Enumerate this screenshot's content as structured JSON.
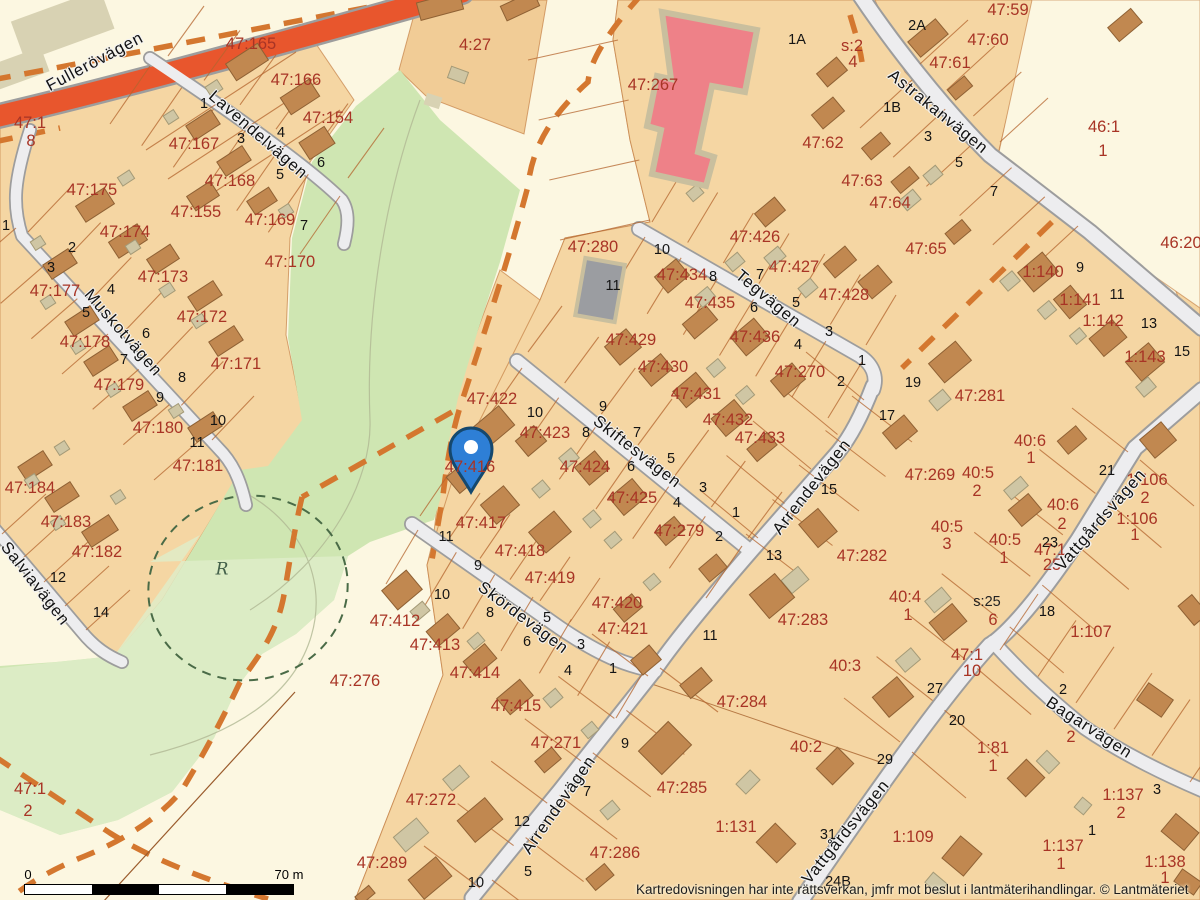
{
  "map": {
    "attribution": "Kartredovisningen har inte rättsverkan, jmfr mot beslut i lantmäterihandlingar. © Lantmäteriet",
    "scale_bar": {
      "start_label": "0",
      "end_label": "70 m"
    },
    "marker": {
      "name": "location-pin",
      "fill": "#2e7fd6",
      "stroke": "#15486e",
      "dot": "#ffffff"
    },
    "colors": {
      "parcel_tan": "#f5d6a3",
      "parcel_dark_tan": "#f1cc96",
      "unbuilt_cream": "#fcf7e1",
      "park_green": "#cfe6b2",
      "park_light_green": "#dfeec9",
      "road_fill": "#ededef",
      "road_casing": "#a0a0a0",
      "main_road": "#e8562d",
      "building_brown": "#c18850",
      "building_accessory": "#cfc6a4",
      "building_red": "#ee8188",
      "building_gray": "#9b9da1",
      "boundary_line": "#b4652e",
      "dashed_orange": "#d4772f",
      "dashed_green": "#4a6b47",
      "label_red": "#a83425",
      "label_black": "#141414"
    },
    "street_labels": [
      {
        "text": "Fullerövägen",
        "x": 95,
        "y": 62,
        "rot": -28
      },
      {
        "text": "Lavendelvägen",
        "x": 258,
        "y": 135,
        "rot": 41
      },
      {
        "text": "Muskotvägen",
        "x": 123,
        "y": 333,
        "rot": 49
      },
      {
        "text": "Salviavägen",
        "x": 35,
        "y": 584,
        "rot": 52
      },
      {
        "text": "Tegvägen",
        "x": 768,
        "y": 299,
        "rot": 40
      },
      {
        "text": "Skiftesvägen",
        "x": 637,
        "y": 452,
        "rot": 38
      },
      {
        "text": "Skördevägen",
        "x": 523,
        "y": 618,
        "rot": 37
      },
      {
        "text": "Arrendevägen",
        "x": 812,
        "y": 487,
        "rot": -52
      },
      {
        "text": "Arrendevägen",
        "x": 559,
        "y": 805,
        "rot": -55
      },
      {
        "text": "Astrakanvägen",
        "x": 938,
        "y": 112,
        "rot": 39
      },
      {
        "text": "Vattgårdsvägen",
        "x": 1101,
        "y": 520,
        "rot": -49
      },
      {
        "text": "Vattgårdsvägen",
        "x": 846,
        "y": 832,
        "rot": -51
      },
      {
        "text": "Bagarvägen",
        "x": 1089,
        "y": 728,
        "rot": 33
      }
    ],
    "parcel_labels": [
      {
        "text": "47:165",
        "x": 251,
        "y": 44
      },
      {
        "text": "47:166",
        "x": 296,
        "y": 80
      },
      {
        "text": "47:154",
        "x": 328,
        "y": 118
      },
      {
        "text": "47:167",
        "x": 194,
        "y": 144
      },
      {
        "text": "47:175",
        "x": 92,
        "y": 190
      },
      {
        "text": "47:168",
        "x": 230,
        "y": 181
      },
      {
        "text": "47:155",
        "x": 196,
        "y": 212
      },
      {
        "text": "47:169",
        "x": 270,
        "y": 220
      },
      {
        "text": "47:174",
        "x": 125,
        "y": 232
      },
      {
        "text": "47:173",
        "x": 163,
        "y": 277
      },
      {
        "text": "47:177",
        "x": 55,
        "y": 291
      },
      {
        "text": "47:170",
        "x": 290,
        "y": 262
      },
      {
        "text": "47:172",
        "x": 202,
        "y": 317
      },
      {
        "text": "47:178",
        "x": 85,
        "y": 342
      },
      {
        "text": "47:171",
        "x": 236,
        "y": 364
      },
      {
        "text": "47:179",
        "x": 119,
        "y": 385
      },
      {
        "text": "47:180",
        "x": 158,
        "y": 428
      },
      {
        "text": "47:181",
        "x": 198,
        "y": 466
      },
      {
        "text": "47:184",
        "x": 30,
        "y": 488
      },
      {
        "text": "47:183",
        "x": 66,
        "y": 522
      },
      {
        "text": "47:182",
        "x": 97,
        "y": 552
      },
      {
        "text": "47:1",
        "x": 30,
        "y": 123
      },
      {
        "text": "8",
        "x": 31,
        "y": 141
      },
      {
        "text": "4:27",
        "x": 475,
        "y": 45
      },
      {
        "text": "47:267",
        "x": 653,
        "y": 85
      },
      {
        "text": "47:280",
        "x": 593,
        "y": 247
      },
      {
        "text": "s:2",
        "x": 852,
        "y": 46
      },
      {
        "text": "4",
        "x": 853,
        "y": 62
      },
      {
        "text": "47:434",
        "x": 682,
        "y": 275
      },
      {
        "text": "47:435",
        "x": 710,
        "y": 303
      },
      {
        "text": "47:429",
        "x": 631,
        "y": 340
      },
      {
        "text": "47:436",
        "x": 755,
        "y": 337
      },
      {
        "text": "47:430",
        "x": 663,
        "y": 367
      },
      {
        "text": "47:431",
        "x": 696,
        "y": 394
      },
      {
        "text": "47:432",
        "x": 728,
        "y": 420
      },
      {
        "text": "47:433",
        "x": 760,
        "y": 438
      },
      {
        "text": "47:426",
        "x": 755,
        "y": 237
      },
      {
        "text": "47:427",
        "x": 794,
        "y": 267
      },
      {
        "text": "47:428",
        "x": 844,
        "y": 295
      },
      {
        "text": "47:270",
        "x": 800,
        "y": 372
      },
      {
        "text": "47:62",
        "x": 823,
        "y": 143
      },
      {
        "text": "47:63",
        "x": 862,
        "y": 181
      },
      {
        "text": "47:64",
        "x": 890,
        "y": 203
      },
      {
        "text": "47:65",
        "x": 926,
        "y": 249
      },
      {
        "text": "47:59",
        "x": 1008,
        "y": 10
      },
      {
        "text": "47:60",
        "x": 988,
        "y": 40
      },
      {
        "text": "47:61",
        "x": 950,
        "y": 63
      },
      {
        "text": "46:1",
        "x": 1104,
        "y": 127
      },
      {
        "text": "1",
        "x": 1103,
        "y": 151
      },
      {
        "text": "46:20",
        "x": 1181,
        "y": 243
      },
      {
        "text": "1:140",
        "x": 1043,
        "y": 272
      },
      {
        "text": "1:141",
        "x": 1080,
        "y": 300
      },
      {
        "text": "1:142",
        "x": 1103,
        "y": 321
      },
      {
        "text": "1:143",
        "x": 1145,
        "y": 357
      },
      {
        "text": "47:281",
        "x": 980,
        "y": 396
      },
      {
        "text": "47:269",
        "x": 930,
        "y": 475
      },
      {
        "text": "47:422",
        "x": 492,
        "y": 399
      },
      {
        "text": "47:423",
        "x": 545,
        "y": 433
      },
      {
        "text": "47:424",
        "x": 585,
        "y": 467
      },
      {
        "text": "47:425",
        "x": 632,
        "y": 498
      },
      {
        "text": "47:279",
        "x": 679,
        "y": 531
      },
      {
        "text": "47:416",
        "x": 470,
        "y": 467
      },
      {
        "text": "47:417",
        "x": 481,
        "y": 523
      },
      {
        "text": "47:418",
        "x": 520,
        "y": 551
      },
      {
        "text": "47:419",
        "x": 550,
        "y": 578
      },
      {
        "text": "47:420",
        "x": 617,
        "y": 603
      },
      {
        "text": "47:421",
        "x": 623,
        "y": 629
      },
      {
        "text": "47:412",
        "x": 395,
        "y": 621
      },
      {
        "text": "47:413",
        "x": 435,
        "y": 645
      },
      {
        "text": "47:414",
        "x": 475,
        "y": 673
      },
      {
        "text": "47:415",
        "x": 516,
        "y": 706
      },
      {
        "text": "47:271",
        "x": 556,
        "y": 743
      },
      {
        "text": "47:276",
        "x": 355,
        "y": 681
      },
      {
        "text": "47:272",
        "x": 431,
        "y": 800
      },
      {
        "text": "47:289",
        "x": 382,
        "y": 863
      },
      {
        "text": "47:282",
        "x": 862,
        "y": 556
      },
      {
        "text": "47:283",
        "x": 803,
        "y": 620
      },
      {
        "text": "40:3",
        "x": 845,
        "y": 666
      },
      {
        "text": "40:2",
        "x": 806,
        "y": 747
      },
      {
        "text": "47:284",
        "x": 742,
        "y": 702
      },
      {
        "text": "47:285",
        "x": 682,
        "y": 788
      },
      {
        "text": "1:131",
        "x": 736,
        "y": 827
      },
      {
        "text": "47:286",
        "x": 615,
        "y": 853
      },
      {
        "text": "1:109",
        "x": 913,
        "y": 837
      },
      {
        "text": "1:107",
        "x": 1091,
        "y": 632
      },
      {
        "text": "40:6",
        "x": 1030,
        "y": 441
      },
      {
        "text": "1",
        "x": 1031,
        "y": 458
      },
      {
        "text": "40:5",
        "x": 978,
        "y": 473
      },
      {
        "text": "2",
        "x": 977,
        "y": 491
      },
      {
        "text": "40:6",
        "x": 1063,
        "y": 505
      },
      {
        "text": "2",
        "x": 1062,
        "y": 524
      },
      {
        "text": "1:106",
        "x": 1147,
        "y": 480
      },
      {
        "text": "2",
        "x": 1145,
        "y": 498
      },
      {
        "text": "1:106",
        "x": 1137,
        "y": 519
      },
      {
        "text": "1",
        "x": 1135,
        "y": 535
      },
      {
        "text": "40:5",
        "x": 947,
        "y": 527
      },
      {
        "text": "3",
        "x": 947,
        "y": 544
      },
      {
        "text": "40:5",
        "x": 1005,
        "y": 540
      },
      {
        "text": "1",
        "x": 1004,
        "y": 558
      },
      {
        "text": "47:1",
        "x": 1050,
        "y": 550
      },
      {
        "text": "25",
        "x": 1052,
        "y": 565
      },
      {
        "text": "40:4",
        "x": 905,
        "y": 597
      },
      {
        "text": "1",
        "x": 908,
        "y": 615
      },
      {
        "text": "47:1",
        "x": 967,
        "y": 655
      },
      {
        "text": "10",
        "x": 972,
        "y": 671
      },
      {
        "text": "6",
        "x": 993,
        "y": 620
      },
      {
        "text": "47:1",
        "x": 30,
        "y": 789
      },
      {
        "text": "2",
        "x": 28,
        "y": 811
      },
      {
        "text": "1:81",
        "x": 993,
        "y": 748
      },
      {
        "text": "1",
        "x": 993,
        "y": 766
      },
      {
        "text": "1:137",
        "x": 1123,
        "y": 795
      },
      {
        "text": "2",
        "x": 1121,
        "y": 813
      },
      {
        "text": "1:137",
        "x": 1063,
        "y": 846
      },
      {
        "text": "1",
        "x": 1061,
        "y": 864
      },
      {
        "text": "1:138",
        "x": 1165,
        "y": 862
      },
      {
        "text": "1",
        "x": 1165,
        "y": 878
      },
      {
        "text": "2",
        "x": 1071,
        "y": 737
      }
    ],
    "house_numbers": [
      {
        "text": "1",
        "x": 204,
        "y": 104
      },
      {
        "text": "3",
        "x": 241,
        "y": 139
      },
      {
        "text": "4",
        "x": 281,
        "y": 133
      },
      {
        "text": "5",
        "x": 280,
        "y": 175
      },
      {
        "text": "6",
        "x": 321,
        "y": 163
      },
      {
        "text": "7",
        "x": 304,
        "y": 226
      },
      {
        "text": "1",
        "x": 6,
        "y": 226
      },
      {
        "text": "2",
        "x": 72,
        "y": 248
      },
      {
        "text": "3",
        "x": 51,
        "y": 268
      },
      {
        "text": "4",
        "x": 111,
        "y": 290
      },
      {
        "text": "5",
        "x": 86,
        "y": 313
      },
      {
        "text": "6",
        "x": 146,
        "y": 334
      },
      {
        "text": "7",
        "x": 124,
        "y": 360
      },
      {
        "text": "8",
        "x": 182,
        "y": 378
      },
      {
        "text": "9",
        "x": 160,
        "y": 398
      },
      {
        "text": "10",
        "x": 218,
        "y": 421
      },
      {
        "text": "11",
        "x": 197,
        "y": 443
      },
      {
        "text": "12",
        "x": 58,
        "y": 578
      },
      {
        "text": "14",
        "x": 101,
        "y": 613
      },
      {
        "text": "2A",
        "x": 917,
        "y": 26
      },
      {
        "text": "1A",
        "x": 797,
        "y": 40
      },
      {
        "text": "1B",
        "x": 892,
        "y": 108
      },
      {
        "text": "3",
        "x": 928,
        "y": 137
      },
      {
        "text": "5",
        "x": 959,
        "y": 163
      },
      {
        "text": "7",
        "x": 994,
        "y": 192
      },
      {
        "text": "9",
        "x": 1080,
        "y": 268
      },
      {
        "text": "11",
        "x": 1117,
        "y": 295
      },
      {
        "text": "13",
        "x": 1149,
        "y": 324
      },
      {
        "text": "15",
        "x": 1182,
        "y": 352
      },
      {
        "text": "19",
        "x": 913,
        "y": 383
      },
      {
        "text": "21",
        "x": 1107,
        "y": 471
      },
      {
        "text": "23",
        "x": 1050,
        "y": 543
      },
      {
        "text": "18",
        "x": 1047,
        "y": 612
      },
      {
        "text": "17",
        "x": 887,
        "y": 416
      },
      {
        "text": "10",
        "x": 662,
        "y": 250
      },
      {
        "text": "11",
        "x": 613,
        "y": 286
      },
      {
        "text": "8",
        "x": 713,
        "y": 277
      },
      {
        "text": "7",
        "x": 760,
        "y": 275
      },
      {
        "text": "6",
        "x": 754,
        "y": 308
      },
      {
        "text": "5",
        "x": 796,
        "y": 303
      },
      {
        "text": "4",
        "x": 798,
        "y": 345
      },
      {
        "text": "3",
        "x": 829,
        "y": 332
      },
      {
        "text": "2",
        "x": 841,
        "y": 382
      },
      {
        "text": "1",
        "x": 862,
        "y": 361
      },
      {
        "text": "10",
        "x": 535,
        "y": 413
      },
      {
        "text": "8",
        "x": 586,
        "y": 433
      },
      {
        "text": "9",
        "x": 603,
        "y": 407
      },
      {
        "text": "7",
        "x": 637,
        "y": 433
      },
      {
        "text": "6",
        "x": 631,
        "y": 467
      },
      {
        "text": "5",
        "x": 671,
        "y": 459
      },
      {
        "text": "4",
        "x": 677,
        "y": 503
      },
      {
        "text": "3",
        "x": 703,
        "y": 488
      },
      {
        "text": "2",
        "x": 719,
        "y": 537
      },
      {
        "text": "1",
        "x": 736,
        "y": 513
      },
      {
        "text": "11",
        "x": 446,
        "y": 537
      },
      {
        "text": "9",
        "x": 478,
        "y": 566
      },
      {
        "text": "10",
        "x": 442,
        "y": 595
      },
      {
        "text": "8",
        "x": 490,
        "y": 613
      },
      {
        "text": "5",
        "x": 547,
        "y": 618
      },
      {
        "text": "6",
        "x": 527,
        "y": 642
      },
      {
        "text": "3",
        "x": 581,
        "y": 645
      },
      {
        "text": "4",
        "x": 568,
        "y": 671
      },
      {
        "text": "1",
        "x": 613,
        "y": 669
      },
      {
        "text": "12",
        "x": 522,
        "y": 822
      },
      {
        "text": "10",
        "x": 476,
        "y": 883
      },
      {
        "text": "7",
        "x": 587,
        "y": 792
      },
      {
        "text": "5",
        "x": 528,
        "y": 872
      },
      {
        "text": "9",
        "x": 625,
        "y": 744
      },
      {
        "text": "11",
        "x": 710,
        "y": 636
      },
      {
        "text": "13",
        "x": 774,
        "y": 556
      },
      {
        "text": "15",
        "x": 829,
        "y": 490
      },
      {
        "text": "20",
        "x": 957,
        "y": 721
      },
      {
        "text": "27",
        "x": 935,
        "y": 689
      },
      {
        "text": "29",
        "x": 885,
        "y": 760
      },
      {
        "text": "31",
        "x": 828,
        "y": 835
      },
      {
        "text": "24B",
        "x": 838,
        "y": 882
      },
      {
        "text": "2",
        "x": 1063,
        "y": 690
      },
      {
        "text": "1",
        "x": 1092,
        "y": 831
      },
      {
        "text": "3",
        "x": 1157,
        "y": 790
      }
    ],
    "special_labels": [
      {
        "text": "s:25",
        "x": 987,
        "y": 602,
        "cls": "special"
      },
      {
        "text": "R",
        "x": 222,
        "y": 570,
        "cls": "rune"
      }
    ]
  }
}
